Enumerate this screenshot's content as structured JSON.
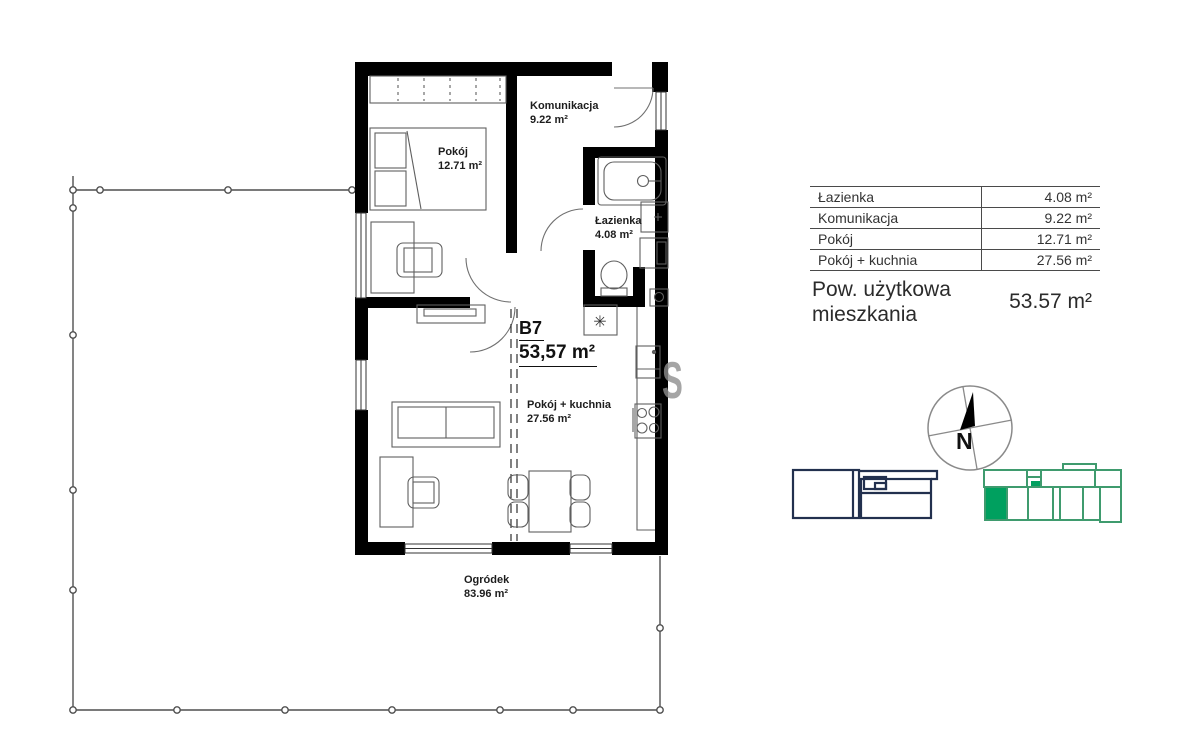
{
  "plan": {
    "unit": {
      "code": "B7",
      "area": "53,57 m²"
    },
    "rooms": {
      "bedroom": {
        "name": "Pokój",
        "area": "12.71 m²"
      },
      "hall": {
        "name": "Komunikacja",
        "area": "9.22 m²"
      },
      "bath": {
        "name": "Łazienka",
        "area": "4.08 m²"
      },
      "living": {
        "name": "Pokój + kuchnia",
        "area": "27.56 m²"
      },
      "garden": {
        "name": "Ogródek",
        "area": "83.96 m²"
      }
    }
  },
  "area_table": {
    "rows": [
      {
        "label": "Łazienka",
        "value": "4.08 m²"
      },
      {
        "label": "Komunikacja",
        "value": "9.22 m²"
      },
      {
        "label": "Pokój",
        "value": "12.71 m²"
      },
      {
        "label": "Pokój + kuchnia",
        "value": "27.56 m²"
      }
    ],
    "summary_label": "Pow. użytkowa mieszkania",
    "summary_value": "53.57 m²"
  },
  "compass": {
    "north": "N"
  },
  "watermark": {
    "letter": "S"
  },
  "icons": {
    "heater_symbol": "✳"
  },
  "colors": {
    "wall": "#000000",
    "navy_outline": "#22304e",
    "green_outline": "#3f9b6e",
    "green_fill": "#00a05f",
    "watermark_gray": "#8f8f8f"
  }
}
